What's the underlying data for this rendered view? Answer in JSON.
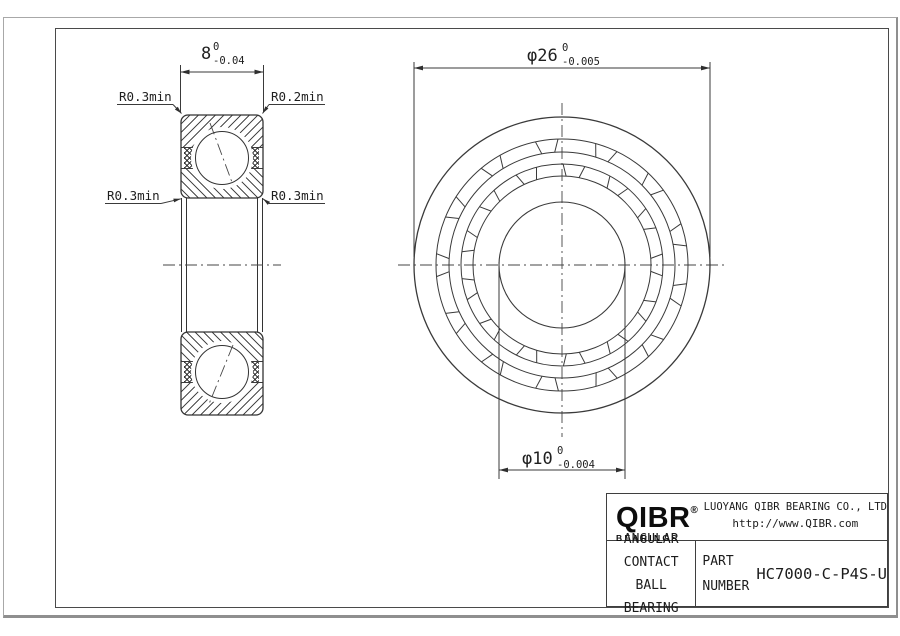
{
  "drawing": {
    "dim_width": {
      "value": "8",
      "tol_upper": "0",
      "tol_lower": "-0.04"
    },
    "dim_outer_diameter": {
      "value": "φ26",
      "tol_upper": "0",
      "tol_lower": "-0.005"
    },
    "dim_bore_diameter": {
      "value": "φ10",
      "tol_upper": "0",
      "tol_lower": "-0.004"
    },
    "labels": {
      "top_left": "R0.3min",
      "top_right": "R0.2min",
      "mid_left": "R0.3min",
      "mid_right": "R0.3min"
    }
  },
  "title_block": {
    "logo_text": "QIBR",
    "logo_registered": "®",
    "logo_subtext": "BEARINGS",
    "company": "LUOYANG QIBR BEARING CO., LTD",
    "website": "http://www.QIBR.com",
    "product_line1": "ANGULAR CONTACT",
    "product_line2": "BALL BEARING",
    "part_label_line1": "PART",
    "part_label_line2": "NUMBER",
    "part_number": "HC7000-C-P4S-U"
  }
}
